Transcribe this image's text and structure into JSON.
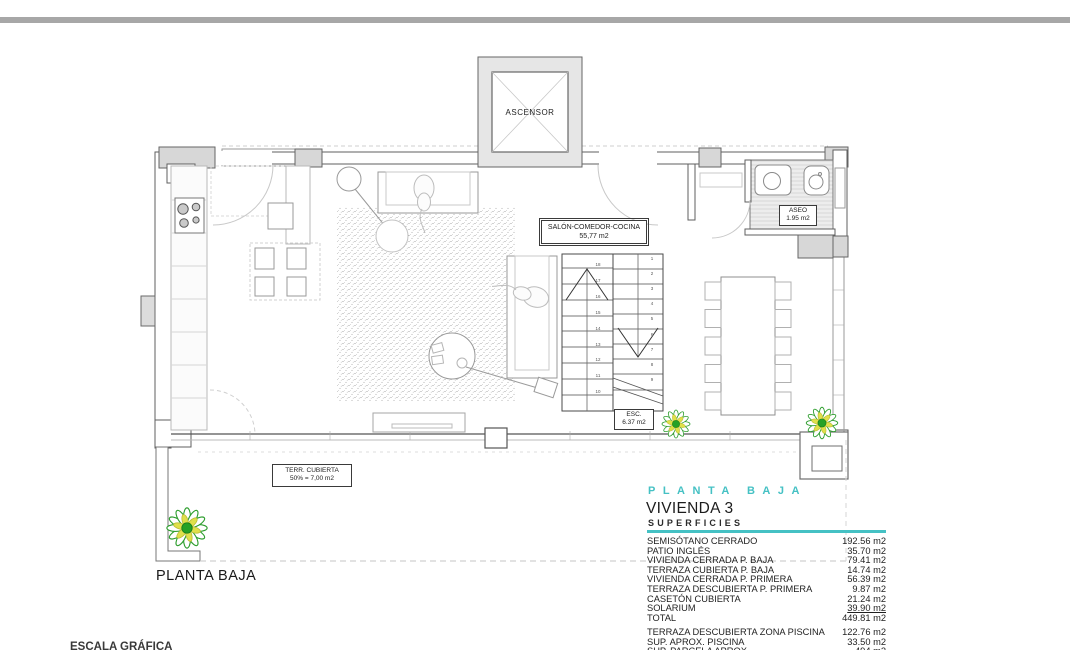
{
  "plan": {
    "ascensor_label": "ASCENSOR",
    "salon_label_line1": "SALÓN-COMEDOR-COCINA",
    "salon_label_line2": "55,77 m2",
    "aseo_label_line1": "ASEO",
    "aseo_label_line2": "1.95 m2",
    "esc_label_line1": "ESC.",
    "esc_label_line2": "6.37 m2",
    "terraza_label_line1": "TERR. CUBIERTA",
    "terraza_label_line2": "50% = 7,00 m2",
    "floor_label": "PLANTA BAJA",
    "escala_label": "ESCALA GRÁFICA",
    "stairs": {
      "left_numbers": [
        18,
        17,
        16,
        15,
        14,
        13,
        12,
        11,
        10
      ],
      "right_numbers": [
        1,
        2,
        3,
        4,
        5,
        6,
        7,
        8,
        9
      ]
    }
  },
  "panel": {
    "title": "PLANTA BAJA",
    "subtitle": "VIVIENDA 3",
    "section": "SUPERFICIES",
    "accent_color": "#45c1c4",
    "rows": [
      {
        "label": "SEMISÓTANO CERRADO",
        "value": "192.56 m2"
      },
      {
        "label": "PATIO INGLÉS",
        "value": "35.70 m2"
      },
      {
        "label": "VIVIENDA CERRADA P. BAJA",
        "value": "79.41 m2"
      },
      {
        "label": "TERRAZA CUBIERTA P. BAJA",
        "value": "14.74 m2"
      },
      {
        "label": "VIVIENDA CERRADA P. PRIMERA",
        "value": "56.39 m2"
      },
      {
        "label": "TERRAZA DESCUBIERTA P. PRIMERA",
        "value": "9.87 m2"
      },
      {
        "label": "CASETÓN CUBIERTA",
        "value": "21.24 m2"
      },
      {
        "label": "SOLARIUM",
        "value": "39.90 m2",
        "underline": true
      },
      {
        "label": "TOTAL",
        "value": "449.81 m2"
      }
    ],
    "rows_secondary": [
      {
        "label": "TERRAZA DESCUBIERTA ZONA PISCINA",
        "value": "122.76 m2"
      },
      {
        "label": "SUP. APROX. PISCINA",
        "value": "33.50 m2"
      },
      {
        "label": "SUP. PARCELA APROX.",
        "value": "494 m2"
      }
    ]
  }
}
